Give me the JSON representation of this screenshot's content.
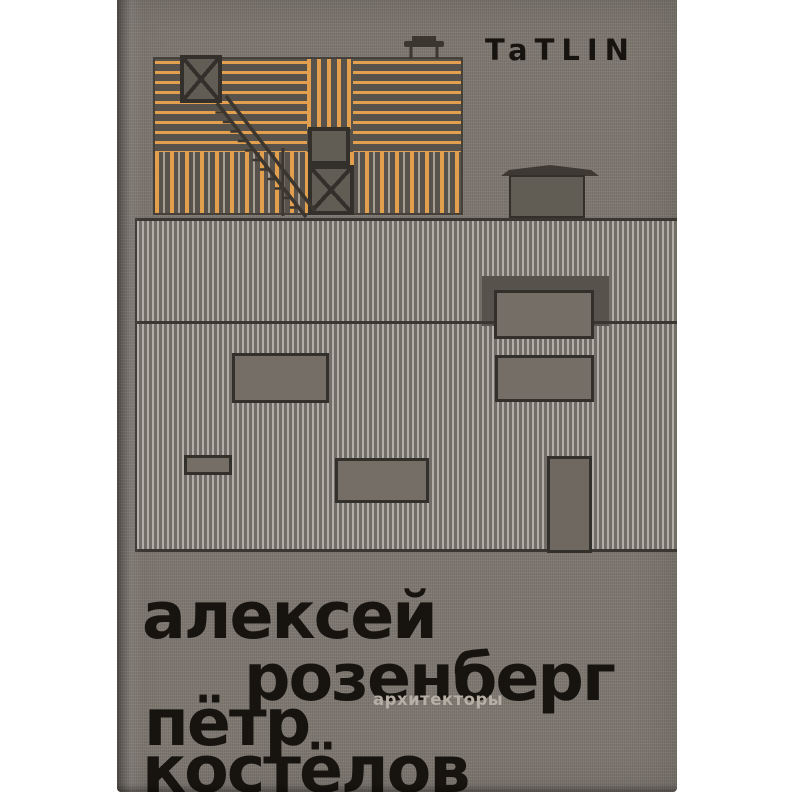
{
  "book_cover": {
    "publisher_logo": "TaTLIN",
    "authors": {
      "line1": "алексей",
      "line2": "розенберг",
      "line3": "пётр",
      "line4": "костёлов"
    },
    "subtitle": "архитекторы",
    "colors": {
      "cover_background": "#7d7770",
      "plank_orange": "#e2a04f",
      "siding_light": "#b2ada6",
      "siding_dark": "#726d66",
      "linework_dark": "#332f2a",
      "title_black": "#17140f",
      "subtitle_gray": "#b5afa6"
    },
    "illustration_parts": [
      "upper-wood-volume",
      "lower-corrugated-volume",
      "external-staircase",
      "braced-window",
      "roof-vent",
      "roof-tank",
      "entry-door"
    ]
  }
}
